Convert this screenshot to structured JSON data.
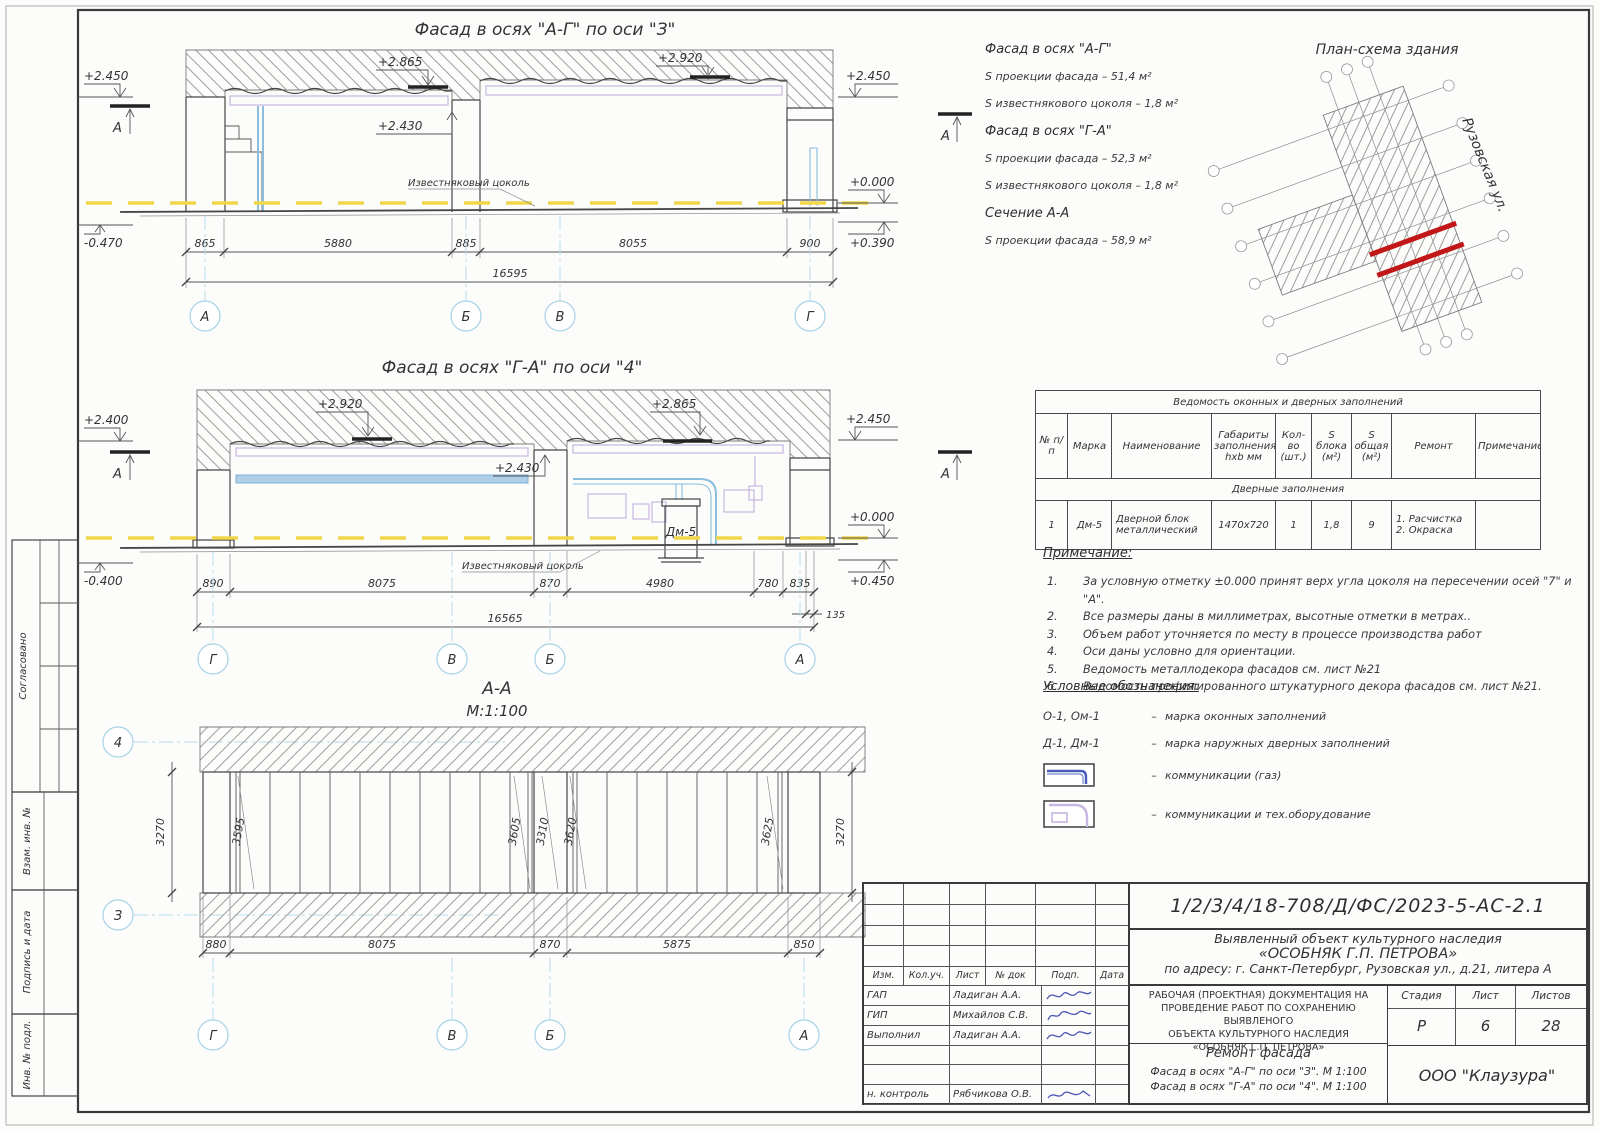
{
  "sidebar": {
    "soglasovano": "Согласовано",
    "vzam": "Взам. инв. №",
    "podpis": "Подпись и дата",
    "inv": "Инв. № подл."
  },
  "facade1": {
    "title": "Фасад  в осях  \"А-Г\"  по оси  \"З\"",
    "marks": {
      "left_top": "+2.450",
      "left_bottom": "-0.470",
      "mid_left": "+2.865",
      "mid_right": "+2.920",
      "pier": "+2.430",
      "right_top": "+2.450",
      "right_zero": "+0.000",
      "right_bottom": "+0.390"
    },
    "section_mark": "А",
    "plinth": "Известняковый цоколь",
    "dims": [
      "865",
      "5880",
      "885",
      "8055",
      "900"
    ],
    "total": "16595",
    "axes": [
      "А",
      "Б",
      "В",
      "Г"
    ]
  },
  "facade2": {
    "title": "Фасад  в осях  \"Г-А\"  по оси  \"4\"",
    "marks": {
      "left_top": "+2.400",
      "left_bottom": "-0.400",
      "mid_left": "+2.920",
      "mid_right": "+2.865",
      "pier": "+2.430",
      "right_top": "+2.450",
      "right_zero": "+0.000",
      "right_bottom": "+0.450"
    },
    "door": "Дм-5",
    "section_mark": "А",
    "plinth": "Известняковый цоколь",
    "dims": [
      "890",
      "8075",
      "870",
      "4980",
      "780",
      "835"
    ],
    "dim_small": "135",
    "total": "16565",
    "axes": [
      "Г",
      "В",
      "Б",
      "А"
    ]
  },
  "section": {
    "title": "А-А",
    "scale": "М:1:100",
    "axis_top": "4",
    "axis_bottom": "З",
    "vdim_left": "3270",
    "vdim_right": "3270",
    "rdims": [
      "3595",
      "3605",
      "3310",
      "3620",
      "3625"
    ],
    "bdims": [
      "880",
      "8075",
      "870",
      "5875",
      "850"
    ],
    "axes": [
      "Г",
      "В",
      "Б",
      "А"
    ]
  },
  "areas": {
    "f1_title": "Фасад в осях \"А-Г\"",
    "f1_line1": "S проекции фасада – 51,4 м²",
    "f1_line2": "S известнякового цоколя – 1,8 м²",
    "f2_title": "Фасад в осях \"Г-А\"",
    "f2_line1": "S проекции фасада – 52,3 м²",
    "f2_line2": "S известнякового цоколя – 1,8 м²",
    "sec_title": "Сечение А-А",
    "sec_line1": "S проекции фасада – 58,9 м²"
  },
  "plan": {
    "title": "План-схема здания",
    "street": "Рузовская ул."
  },
  "table": {
    "title": "Ведомость оконных и дверных заполнений",
    "col_num": "№ п/п",
    "col_mark": "Марка",
    "col_name": "Наименование",
    "col_size": "Габариты заполнения hxb мм",
    "col_qty": "Кол-во (шт.)",
    "col_sblock": "S блока (м²)",
    "col_stotal": "S общая (м²)",
    "col_repair": "Ремонт",
    "col_note": "Примечание",
    "subheader": "Дверные заполнения",
    "row": {
      "num": "1",
      "mark": "Дм-5",
      "name": "Дверной блок металлический",
      "size": "1470x720",
      "qty": "1",
      "s_block": "1,8",
      "s_total": "9",
      "repair1": "1. Расчистка",
      "repair2": "2. Окраска",
      "note": ""
    }
  },
  "notes": {
    "title": "Примечание:",
    "items": [
      {
        "n": "1.",
        "text": "За условную отметку ±0.000 принят верх угла цоколя на пересечении осей \"7\" и \"А\"."
      },
      {
        "n": "2.",
        "text": "Все размеры даны в миллиметрах, высотные отметки в метрах.."
      },
      {
        "n": "3.",
        "text": "Объем работ уточняется по месту в процессе производства работ"
      },
      {
        "n": "4.",
        "text": "Оси даны условно для ориентации."
      },
      {
        "n": "5.",
        "text": "Ведомость металлодекора фасадов см. лист №21"
      },
      {
        "n": "6.",
        "text": "Ведомость профилированного штукатурного декора  фасадов см. лист №21."
      }
    ]
  },
  "legend": {
    "title": "Условные обозначения:",
    "dash": "–",
    "win_key": "О-1, Ом-1",
    "win_desc": "марка оконных заполнений",
    "door_key": "Д-1, Дм-1",
    "door_desc": "марка наружных дверных заполнений",
    "gas_desc": "коммуникации (газ)",
    "tech_desc": "коммуникации  и  тех.оборудование"
  },
  "titleblock": {
    "doc_number": "1/2/3/4/18-708/Д/ФС/2023-5-АС-2.1",
    "object1": "Выявленный объект культурного наследия",
    "object2": "«ОСОБНЯК Г.П. ПЕТРОВА»",
    "object3": "по адресу: г. Санкт-Петербург, Рузовская ул., д.21, литера А",
    "cols": [
      "Изм.",
      "Кол.уч.",
      "Лист",
      "№ док",
      "Подп.",
      "Дата"
    ],
    "rows": [
      {
        "role": "ГАП",
        "name": "Ладиган А.А."
      },
      {
        "role": "ГИП",
        "name": "Михайлов С.В."
      },
      {
        "role": "Выполнил",
        "name": "Ладиган А.А."
      },
      {
        "role": "н. контроль",
        "name": "Рябчикова О.В."
      }
    ],
    "doc_type1": "РАБОЧАЯ (ПРОЕКТНАЯ) ДОКУМЕНТАЦИЯ НА",
    "doc_type2": "ПРОВЕДЕНИЕ РАБОТ ПО СОХРАНЕНИЮ ВЫЯВЛЕНОГО",
    "doc_type3": "ОБЪЕКТА КУЛЬТУРНОГО НАСЛЕДИЯ",
    "doc_type4": "«ОСОБНЯК Г.П. ПЕТРОВА»",
    "stage_label": "Стадия",
    "sheet_label": "Лист",
    "sheets_label": "Листов",
    "stage": "Р",
    "sheet_no": "6",
    "sheets_total": "28",
    "work": "Ремонт фасада",
    "draw1": "Фасад  в осях  \"А-Г\"  по оси  \"З\".  М 1:100",
    "draw2": "Фасад  в осях  \"Г-А\"  по оси  \"4\".  М 1:100",
    "company": "ООО  \"Клаузура\""
  }
}
